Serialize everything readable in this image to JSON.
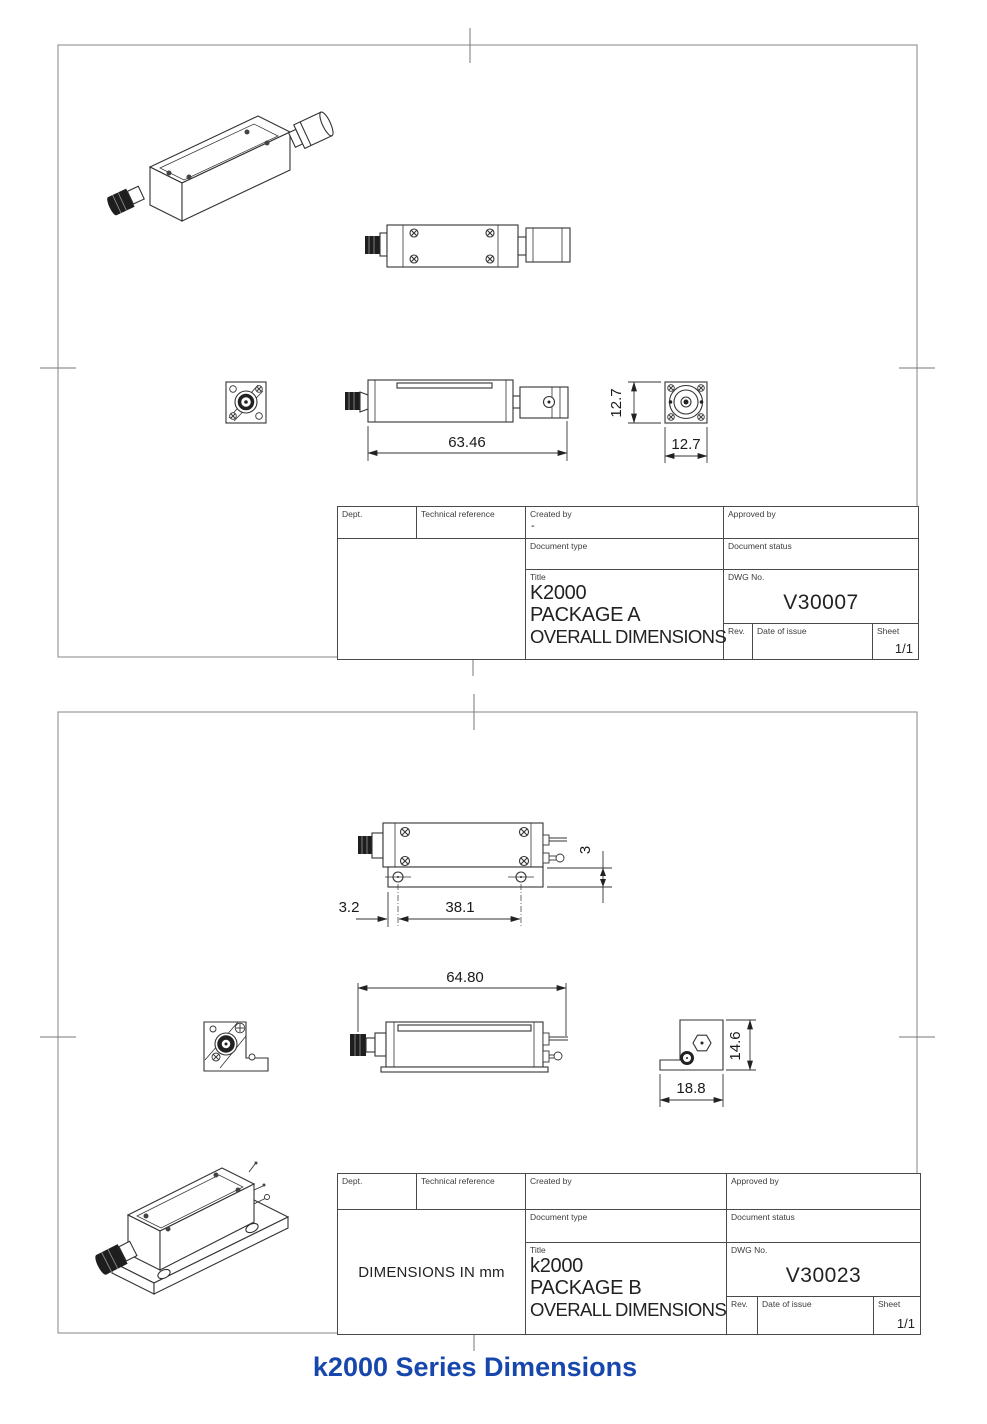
{
  "caption": {
    "text": "k2000 Series Dimensions",
    "color": "#1747ad"
  },
  "sheet_a": {
    "dims": {
      "length": "63.46",
      "height": "12.7",
      "width": "12.7"
    },
    "tb": {
      "dept": "Dept.",
      "tech_ref": "Technical reference",
      "created_by": "Created by",
      "created_by_value": "-",
      "approved_by": "Approved by",
      "doc_type": "Document type",
      "doc_status": "Document status",
      "title_label": "Title",
      "title1": "K2000",
      "title2": "PACKAGE A",
      "title3": "OVERALL DIMENSIONS",
      "dwg_label": "DWG No.",
      "dwg": "V30007",
      "rev": "Rev.",
      "date": "Date of issue",
      "sheet": "Sheet",
      "sheet_value": "1/1",
      "note": ""
    }
  },
  "sheet_b": {
    "dims": {
      "hole_offset": "3.2",
      "hole_spacing": "38.1",
      "pin_offset": "3",
      "length": "64.80",
      "base_width": "18.8",
      "height": "14.6"
    },
    "tb": {
      "dept": "Dept.",
      "tech_ref": "Technical reference",
      "created_by": "Created by",
      "created_by_value": "",
      "approved_by": "Approved by",
      "doc_type": "Document type",
      "doc_status": "Document status",
      "title_label": "Title",
      "title1": "k2000",
      "title2": "PACKAGE B",
      "title3": "OVERALL DIMENSIONS",
      "dwg_label": "DWG No.",
      "dwg": "V30023",
      "rev": "Rev.",
      "date": "Date of issue",
      "sheet": "Sheet",
      "sheet_value": "1/1",
      "note": "DIMENSIONS IN mm"
    }
  }
}
